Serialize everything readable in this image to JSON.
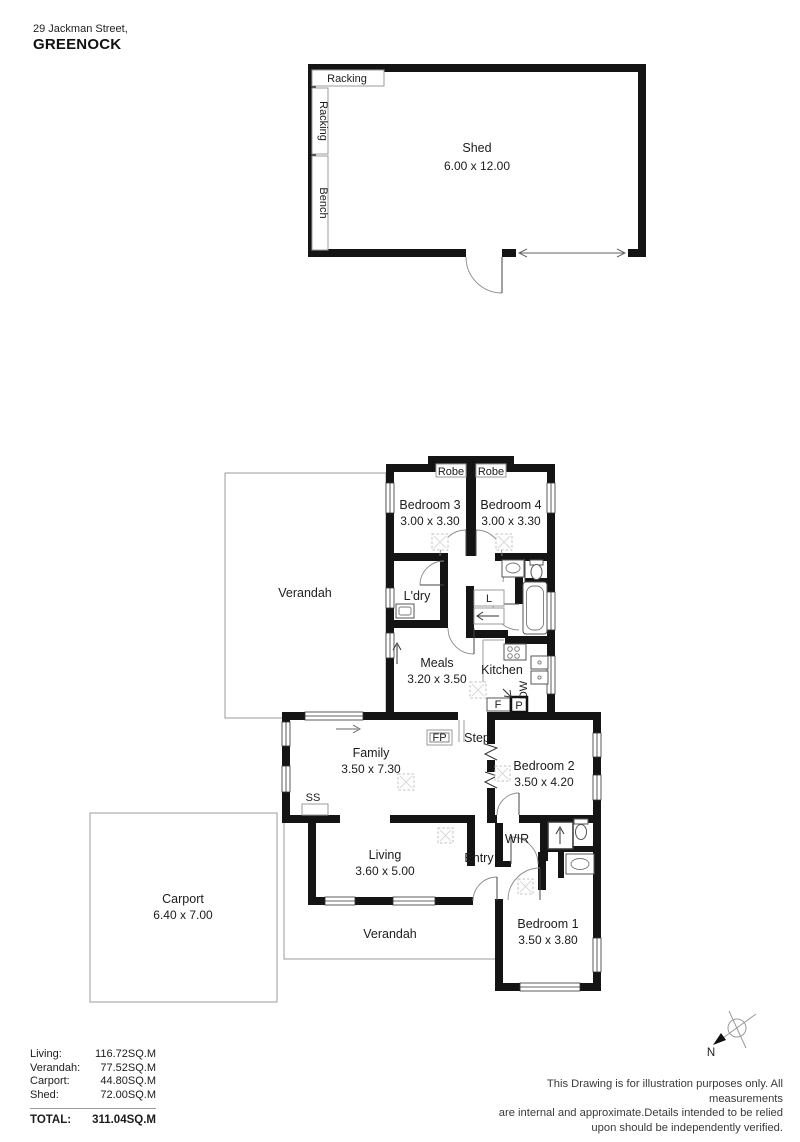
{
  "header": {
    "address": "29 Jackman Street,",
    "suburb": "GREENOCK"
  },
  "shed": {
    "name": "Shed",
    "dims": "6.00 x 12.00",
    "racking_top": "Racking",
    "racking_side": "Racking",
    "bench": "Bench"
  },
  "house": {
    "robe_left": "Robe",
    "robe_right": "Robe",
    "bedroom3": {
      "name": "Bedroom 3",
      "dims": "3.00 x 3.30"
    },
    "bedroom4": {
      "name": "Bedroom 4",
      "dims": "3.00 x 3.30"
    },
    "ldry": "L'dry",
    "linen": "L",
    "meals": {
      "name": "Meals",
      "dims": "3.20 x 3.50"
    },
    "kitchen": "Kitchen",
    "dishwasher": "DW",
    "fridge": "F",
    "pantry": "P",
    "fireplace": "FP",
    "step": "Step",
    "ss": "SS",
    "family": {
      "name": "Family",
      "dims": "3.50 x 7.30"
    },
    "living": {
      "name": "Living",
      "dims": "3.60 x 5.00"
    },
    "bedroom2": {
      "name": "Bedroom 2",
      "dims": "3.50 x 4.20"
    },
    "bedroom1": {
      "name": "Bedroom 1",
      "dims": "3.50 x 3.80"
    },
    "wir": "WIR",
    "entry": "Entry",
    "verandah_top": "Verandah",
    "verandah_bottom": "Verandah"
  },
  "carport": {
    "name": "Carport",
    "dims": "6.40 x 7.00"
  },
  "areas": {
    "rows": [
      {
        "label": "Living:",
        "value": "116.72SQ.M"
      },
      {
        "label": "Verandah:",
        "value": "77.52SQ.M"
      },
      {
        "label": "Carport:",
        "value": "44.80SQ.M"
      },
      {
        "label": "Shed:",
        "value": "72.00SQ.M"
      }
    ],
    "total_label": "TOTAL:",
    "total_value": "311.04SQ.M"
  },
  "compass": {
    "label": "N"
  },
  "disclaimer": {
    "line1": "This Drawing is for illustration purposes only. All measurements",
    "line2": "are internal and approximate.Details intended to be relied",
    "line3": "upon should be independently verified."
  }
}
